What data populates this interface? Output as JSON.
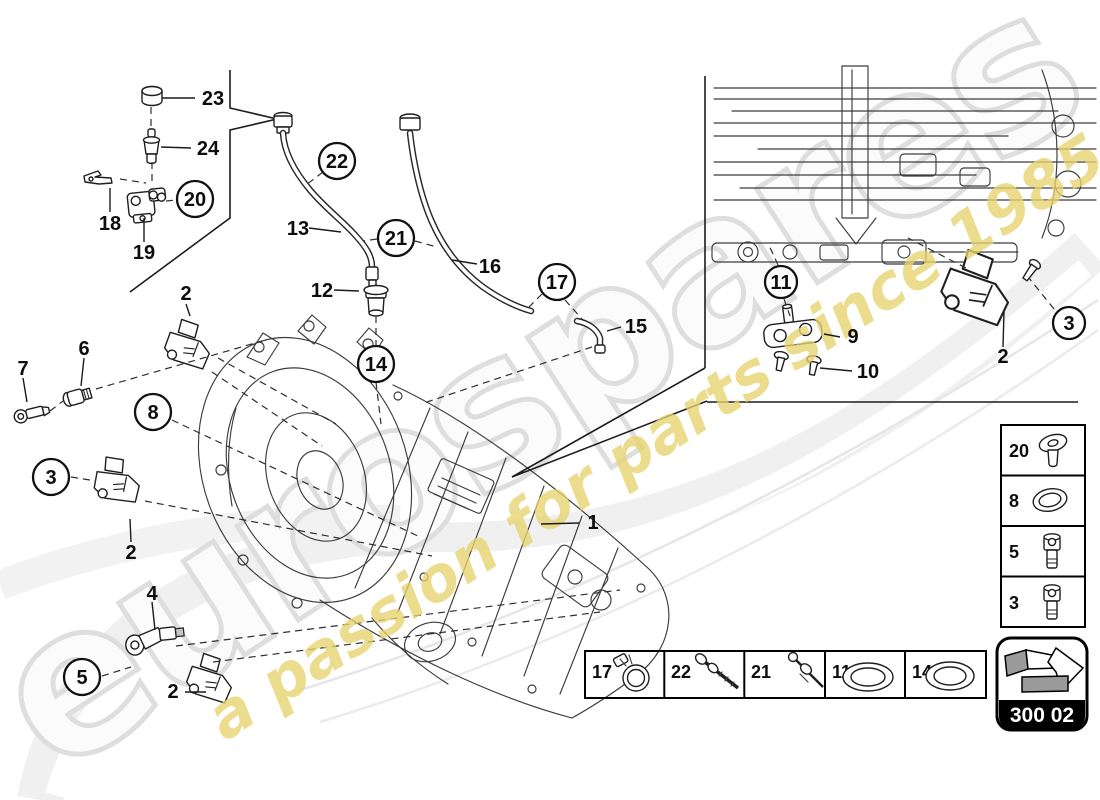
{
  "watermark": {
    "brand": "eurospares",
    "tagline": "a passion for parts since 1985"
  },
  "badge": {
    "code": "300 02"
  },
  "callouts": [
    {
      "label": "23",
      "circled": false
    },
    {
      "label": "24",
      "circled": false
    },
    {
      "label": "18",
      "circled": false
    },
    {
      "label": "19",
      "circled": false
    },
    {
      "label": "20",
      "circled": true
    },
    {
      "label": "2",
      "circled": false
    },
    {
      "label": "13",
      "circled": false
    },
    {
      "label": "22",
      "circled": true
    },
    {
      "label": "21",
      "circled": true
    },
    {
      "label": "16",
      "circled": false
    },
    {
      "label": "17",
      "circled": true
    },
    {
      "label": "15",
      "circled": false
    },
    {
      "label": "12",
      "circled": false
    },
    {
      "label": "14",
      "circled": true
    },
    {
      "label": "7",
      "circled": false
    },
    {
      "label": "6",
      "circled": false
    },
    {
      "label": "8",
      "circled": true
    },
    {
      "label": "3",
      "circled": true
    },
    {
      "label": "2",
      "circled": false
    },
    {
      "label": "4",
      "circled": false
    },
    {
      "label": "5",
      "circled": true
    },
    {
      "label": "2",
      "circled": false
    },
    {
      "label": "1",
      "circled": false
    },
    {
      "label": "11",
      "circled": true
    },
    {
      "label": "9",
      "circled": false
    },
    {
      "label": "10",
      "circled": false
    },
    {
      "label": "3",
      "circled": true
    },
    {
      "label": "2",
      "circled": false
    }
  ],
  "sidebar": {
    "items": [
      {
        "label": "20",
        "icon": "pan-screw-washer-icon"
      },
      {
        "label": "8",
        "icon": "o-ring-icon"
      },
      {
        "label": "5",
        "icon": "cap-screw-icon"
      },
      {
        "label": "3",
        "icon": "cap-screw-icon"
      }
    ]
  },
  "legend": {
    "items": [
      {
        "label": "17",
        "icon": "clamp-icon"
      },
      {
        "label": "22",
        "icon": "screw-icon"
      },
      {
        "label": "21",
        "icon": "screw-icon"
      },
      {
        "label": "11",
        "icon": "o-ring-icon"
      },
      {
        "label": "14",
        "icon": "o-ring-icon"
      }
    ]
  },
  "colors": {
    "line": "#2e2e2e",
    "watermark_gray": "#dedede",
    "watermark_yellow": "#e7d36f",
    "badge_bg": "#000000",
    "badge_text": "#ffffff",
    "paper": "#ffffff"
  }
}
